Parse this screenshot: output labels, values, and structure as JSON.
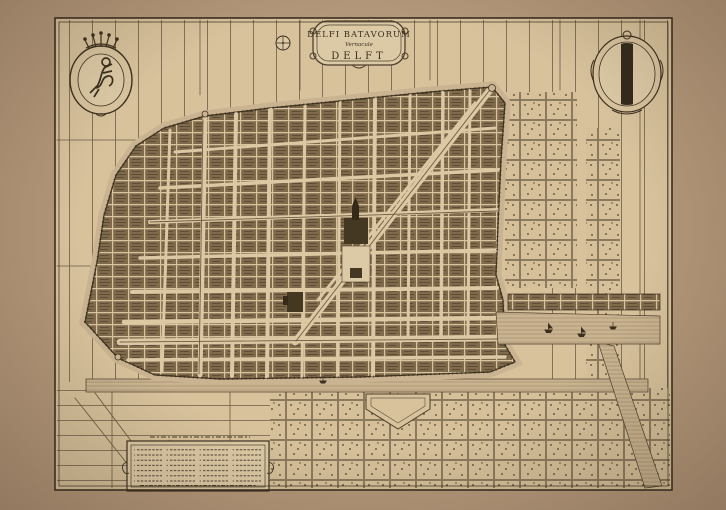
{
  "title_cartouche": {
    "line1": "DELFI BATAVORUM",
    "line2": "Vernacule",
    "line3": "DELFT"
  },
  "heraldry": {
    "left_crest": "crowned shield with rampant lion",
    "right_crest": "Delft arms: shield with black vertical pale"
  },
  "colors": {
    "paper_margin": "#b3977a",
    "plate_paper": "#d7c29c",
    "ink": "#3b2f1f",
    "water": "#c9b390",
    "city_blocks": "#7f6a4c",
    "cartouche_fill": "#dccaa6"
  }
}
